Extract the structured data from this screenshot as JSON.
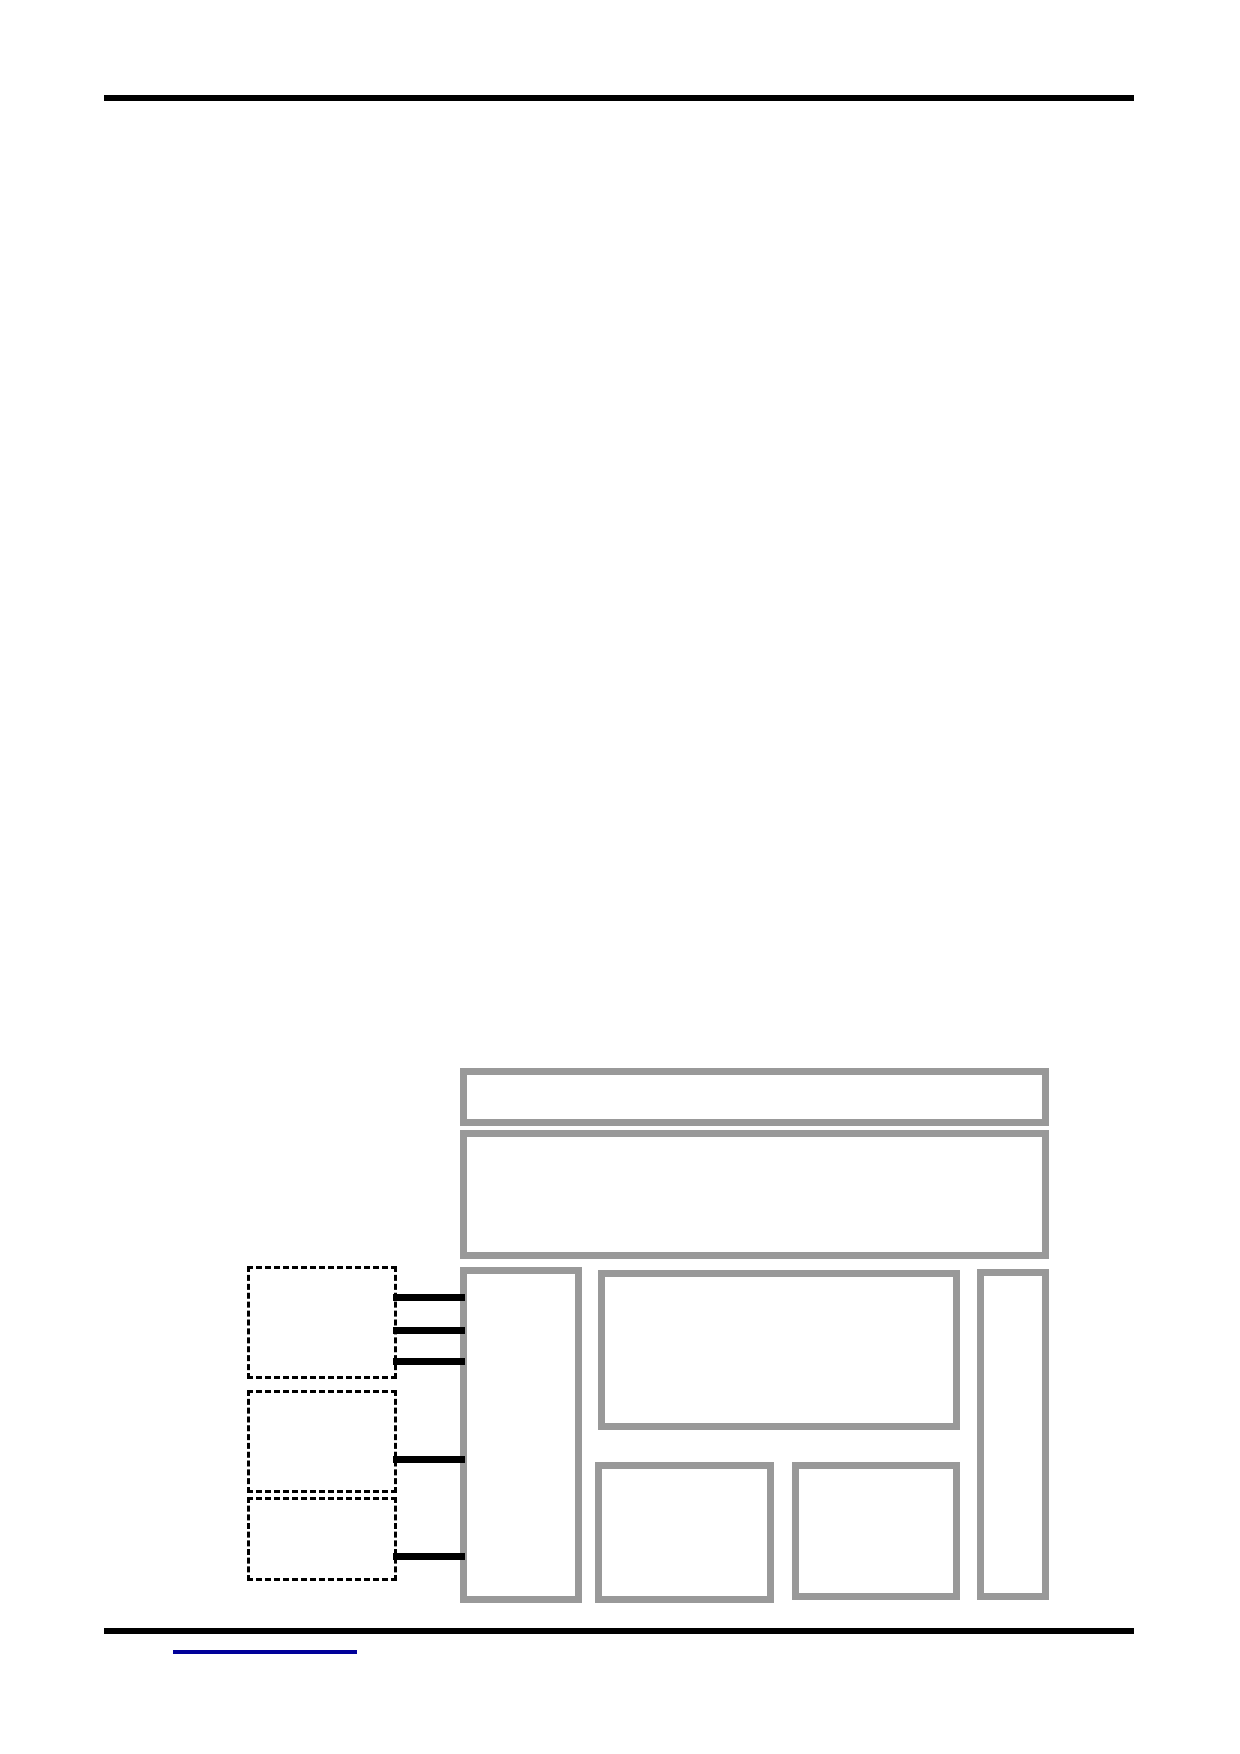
{
  "colors": {
    "page-bg": "#ffffff",
    "rule-black": "#000000",
    "box-border-gray": "#999999",
    "dashed-border-black": "#000000",
    "connector-black": "#000000",
    "link-underline-blue": "#000099"
  },
  "header": {
    "rule": "full-width-horizontal-rule"
  },
  "figure": {
    "type": "block-layout-diagram",
    "solid_boxes": [
      {
        "name": "top-bar"
      },
      {
        "name": "header-panel"
      },
      {
        "name": "left-column"
      },
      {
        "name": "main-panel"
      },
      {
        "name": "bottom-left-panel"
      },
      {
        "name": "bottom-right-panel"
      },
      {
        "name": "right-column"
      }
    ],
    "dashed_boxes": [
      {
        "name": "callout-1",
        "connector_count": 3
      },
      {
        "name": "callout-2",
        "connector_count": 1
      },
      {
        "name": "callout-3",
        "connector_count": 1
      }
    ],
    "connectors": [
      {
        "from": "callout-1",
        "to": "left-column"
      },
      {
        "from": "callout-1",
        "to": "left-column"
      },
      {
        "from": "callout-1",
        "to": "left-column"
      },
      {
        "from": "callout-2",
        "to": "left-column"
      },
      {
        "from": "callout-3",
        "to": "left-column"
      }
    ]
  },
  "footer": {
    "rule": "full-width-horizontal-rule",
    "link": {
      "text": "",
      "style": "underlined-blank-hyperlink"
    }
  }
}
